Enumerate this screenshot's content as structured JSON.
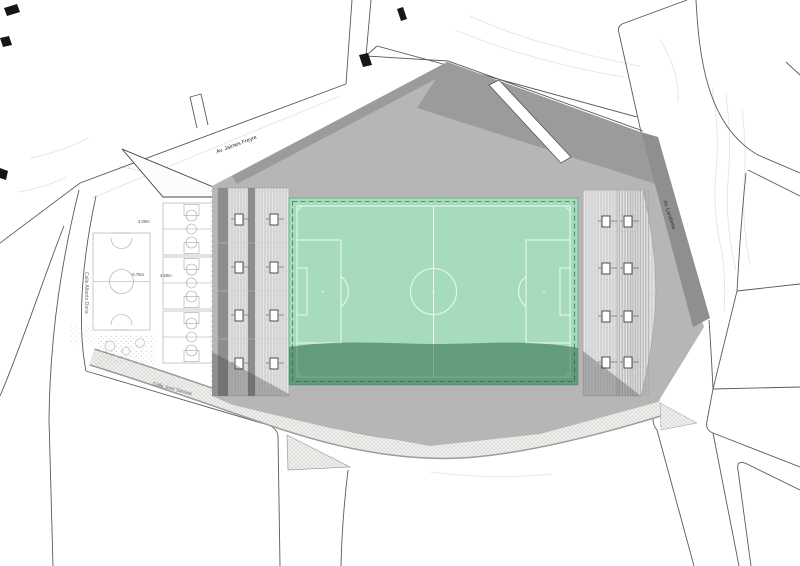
{
  "labels": {
    "avenue_top": "Av. Jaimes Freyre",
    "avenue_right": "Av. Landaeta",
    "street_left": "Calle Alberto Doria",
    "street_bottom": "Calle José Saravia"
  },
  "dimensions": {
    "courts_top": "4.00m",
    "futsal_level": "-0.75m",
    "courts_level": "4.50m"
  },
  "colors": {
    "background": "#ffffff",
    "field_green": "#a6dcbc",
    "field_line": "#eef9f2",
    "field_border_dash": "#3e8e62",
    "field_shadow": "#1e5c3d",
    "esplanade_gray": "#b6b6b6",
    "roof_gray": "#9b9b9b",
    "landaeta_band_gray": "#8f8f8f",
    "stand_dark_strip": "#8d8d8d",
    "shadow_gray": "#3f3f3f",
    "street_line": "#5a5a5a"
  }
}
